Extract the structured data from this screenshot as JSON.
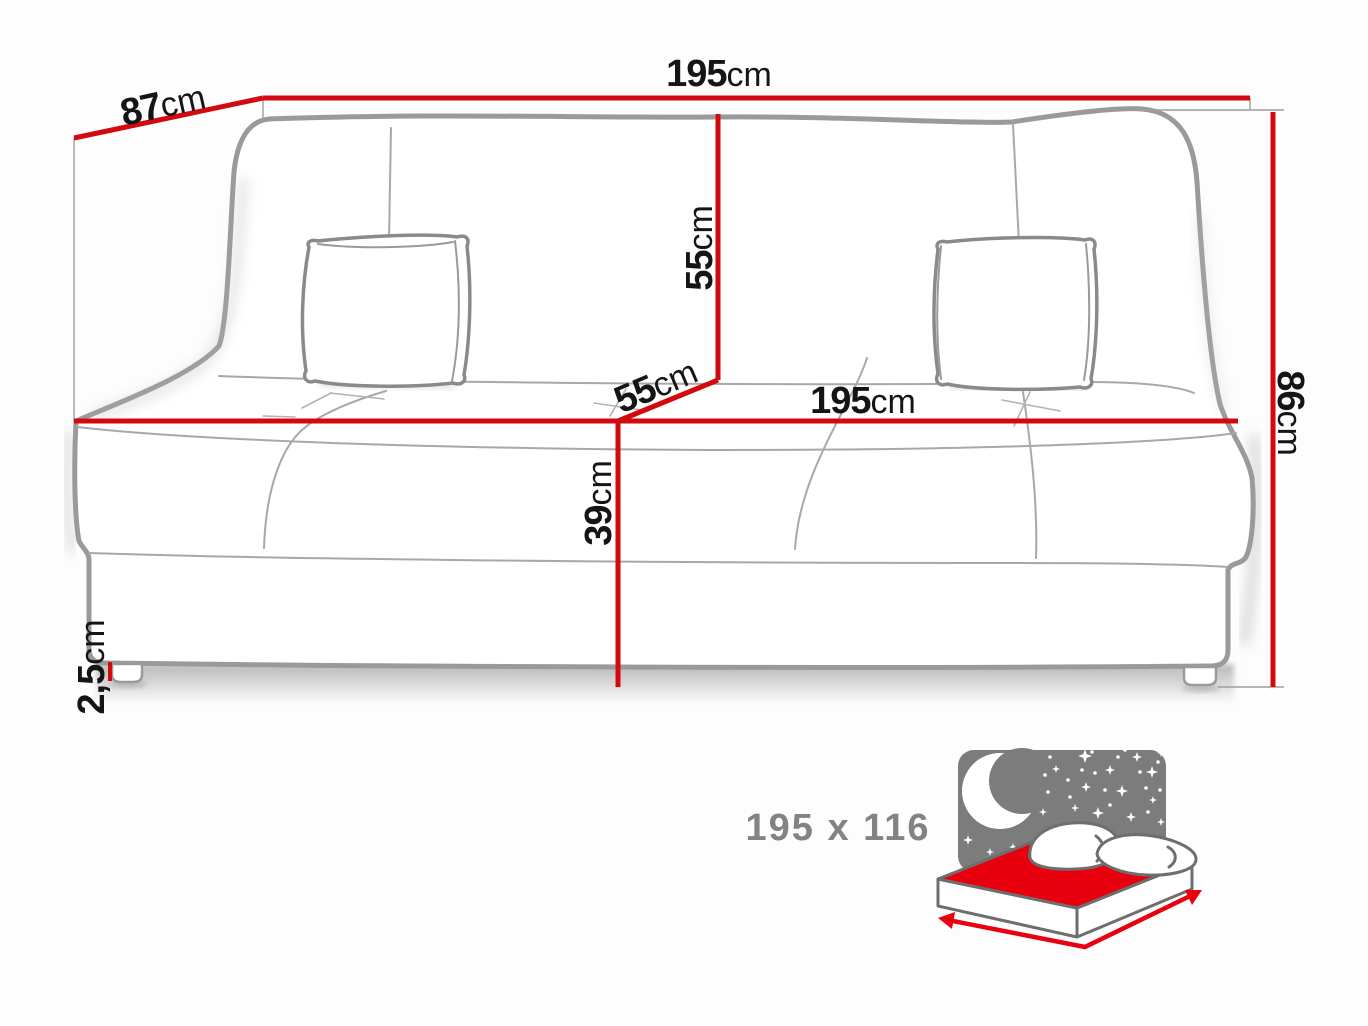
{
  "title": "Sofa bed dimensions diagram",
  "colors": {
    "dimension_red": "#d20a0f",
    "sketch_gray": "#9a9a9a",
    "thin_gray": "#a8a8a8",
    "label_black": "#151515",
    "icon_panel_gray": "#7c7c7c",
    "icon_outline_gray": "#6e6e6e",
    "bed_red": "#e8000f",
    "size_text_gray": "#838383",
    "background": "#fdfdfd"
  },
  "dimensions": {
    "top_width": {
      "value": "195",
      "unit": "cm"
    },
    "depth": {
      "value": "87",
      "unit": "cm"
    },
    "backrest_height": {
      "value": "55",
      "unit": "cm"
    },
    "seat_depth": {
      "value": "55",
      "unit": "cm"
    },
    "seat_width": {
      "value": "195",
      "unit": "cm"
    },
    "total_height": {
      "value": "86",
      "unit": "cm"
    },
    "seat_height": {
      "value": "39",
      "unit": "cm"
    },
    "leg_height": {
      "value": "2,5",
      "unit": "cm"
    }
  },
  "sleeping_area": {
    "size_label": "195 x 116",
    "icon": "night-sleeping-area-bed-icon"
  }
}
